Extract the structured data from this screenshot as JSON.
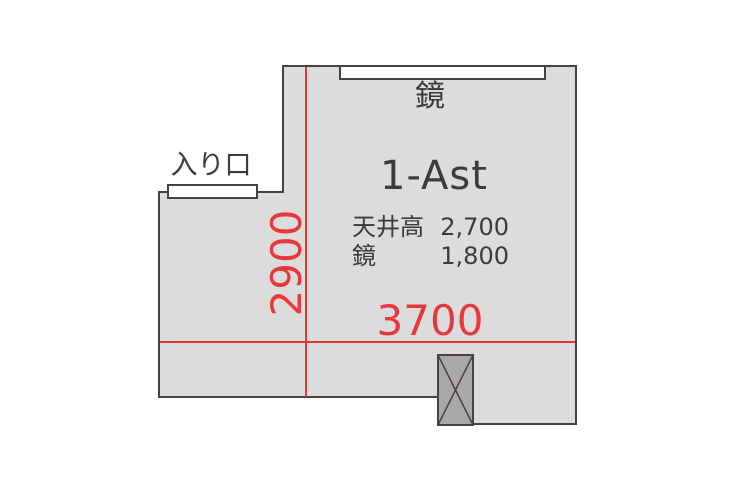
{
  "floorplan": {
    "room_id": "1-Ast",
    "labels": {
      "mirror": "鏡",
      "entrance": "入り口"
    },
    "dimensions": {
      "width_mm": "3700",
      "depth_mm": "2900"
    },
    "specs": [
      {
        "label": "天井高",
        "value": "2,700"
      },
      {
        "label": "鏡",
        "value": "1,800"
      }
    ],
    "colors": {
      "accent-red": "#e8383d",
      "wall": "#474241",
      "room-fill": "#dcdcdd",
      "pillar-fill": "#a9a7a8",
      "bar-fill": "#ffffff",
      "text": "#3e3a39"
    }
  }
}
